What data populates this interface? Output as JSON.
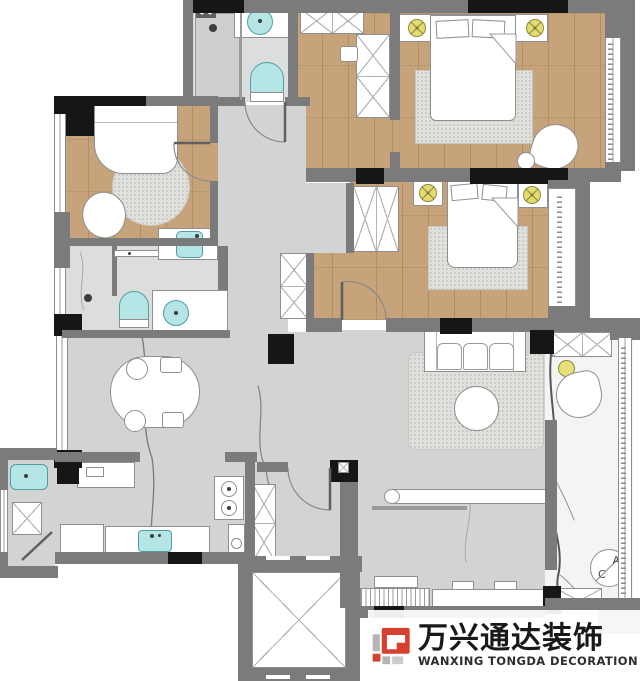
{
  "brand": {
    "name_cn": "万兴通达装饰",
    "name_en": "WANXING TONGDA DECORATION",
    "accent": "#d6412f"
  },
  "ac_unit": {
    "letter_top": "A",
    "letter_bottom": "C"
  },
  "palette": {
    "wall": "#7b7b7b",
    "column": "#161616",
    "wood_floor": "#c6a37a",
    "tile_floor": "#d2d4d3",
    "bath_tile": "#dcdedd",
    "marble_floor": "#f4f4f3",
    "fixture_teal": "#b5e5e4",
    "lamp_yellow": "#e4da6d",
    "rug": "#e0e0dd",
    "furniture_outline": "#8f8f8f",
    "vein": "#2f2f2f"
  }
}
